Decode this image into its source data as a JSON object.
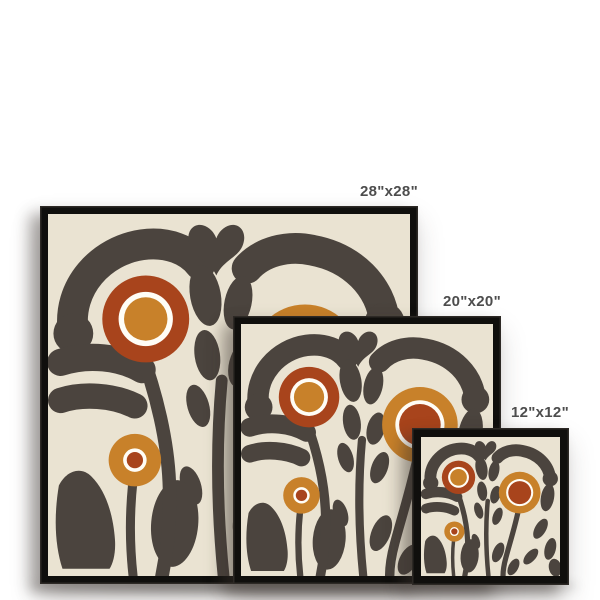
{
  "scene": {
    "description": "Framed square art print size comparison mockup",
    "wall_color": "#ffffff"
  },
  "frames": [
    {
      "label": "28\"x28\""
    },
    {
      "label": "20\"x20\""
    },
    {
      "label": "12\"x12\""
    }
  ],
  "artwork": {
    "name": "abstract-retro-flowers-print",
    "colors": {
      "wall": "#ffffff",
      "art_bg": "#eae3d2",
      "foliage": "#4b443e",
      "rust": "#a8441c",
      "amber": "#c8812a",
      "ring": "#fffdf6",
      "frame": "#100f0d",
      "label": "#4d4d4d"
    }
  }
}
